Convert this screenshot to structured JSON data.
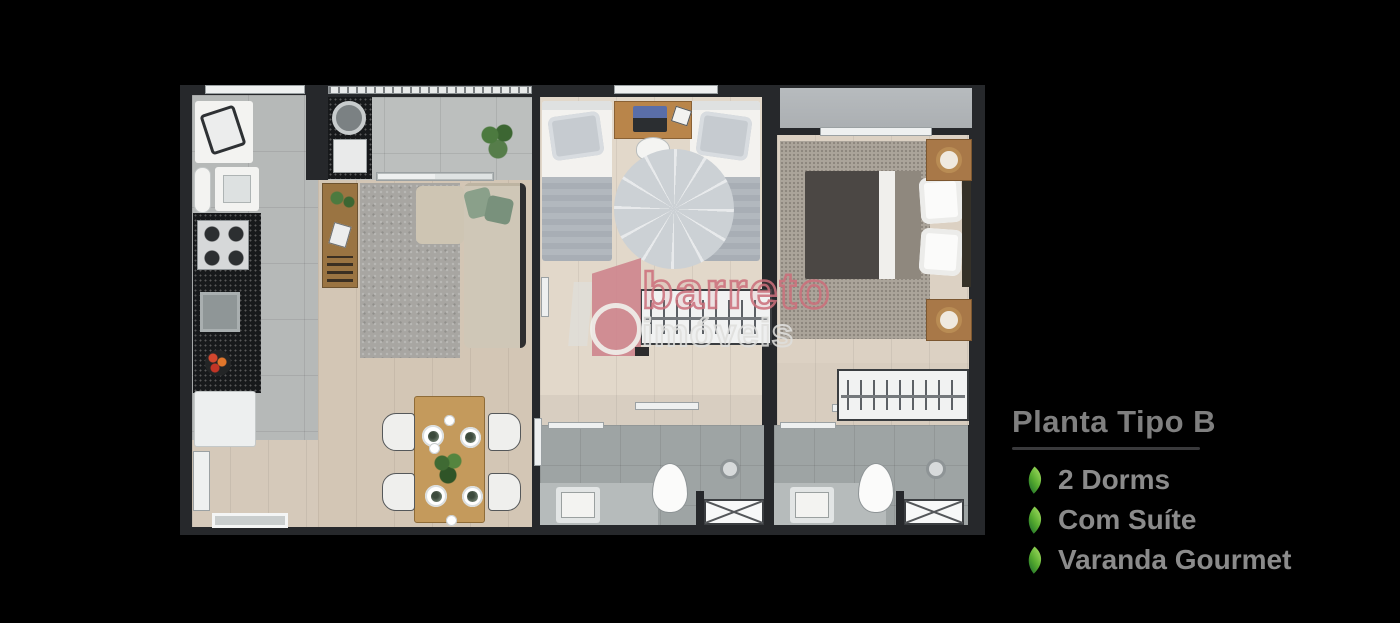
{
  "page": {
    "background_color": "#000000"
  },
  "info_panel": {
    "title": "Planta Tipo B",
    "title_color": "#7f7f7f",
    "underline_color": "#3a3a3c",
    "feature_text_color": "#8b8b8b",
    "features": [
      {
        "icon": "leaf-icon",
        "label": "2 Dorms"
      },
      {
        "icon": "leaf-icon",
        "label": "Com Suíte"
      },
      {
        "icon": "leaf-icon",
        "label": "Varanda Gourmet"
      }
    ],
    "leaf_gradient": [
      "#a8e063",
      "#1d6f2b"
    ]
  },
  "watermark": {
    "brand_line1": "barreto",
    "brand_line2": "imóveis",
    "line1_color": "#cb707b",
    "line2_color": "#dededc",
    "logo": {
      "flag_color": "#ce828b",
      "bar_color": "#e1dfda",
      "ring_color": "#f2f1ee"
    }
  },
  "floorplan": {
    "wall_color": "#26282b",
    "floor_colors": {
      "kitchen_tile": "#b6b9b8",
      "balcony_tile": "#bcbfbe",
      "living_wood": "#d3c6b5",
      "bedroom_wood": "#e2d8ca",
      "suite_wood": "#dcd1c3",
      "bathroom_tile": "#9ea4a4",
      "terrace": "#b1b5b8",
      "counter_granite": "#17191b"
    }
  }
}
